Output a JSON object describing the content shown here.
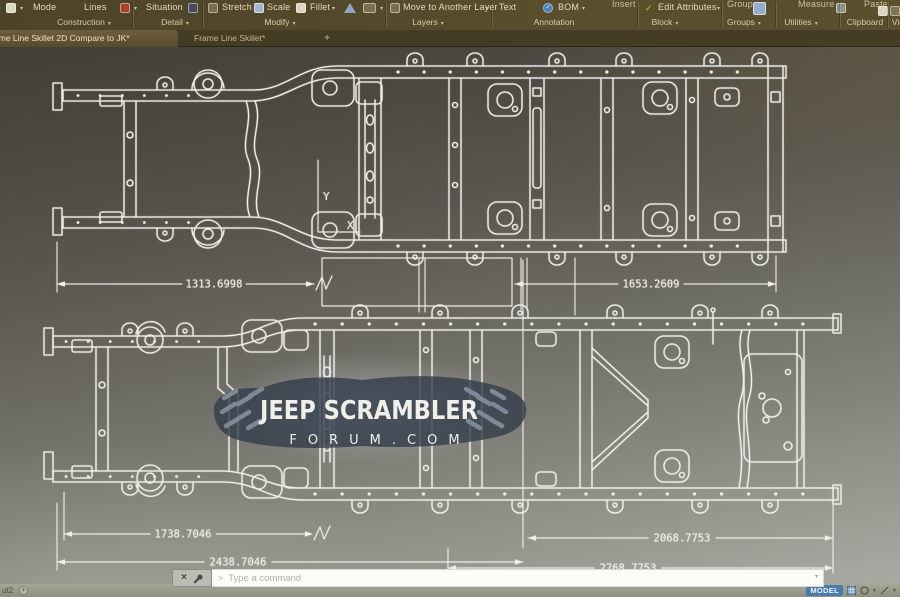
{
  "ribbon": {
    "tools": {
      "mode": "Mode",
      "lines": "Lines",
      "situation": "Situation",
      "stretch": "Stretch",
      "scale": "Scale",
      "fillet": "Fillet",
      "move_to_another_layer": "Move to Another Layer",
      "text": "Text",
      "bom": "BOM",
      "insert": "Insert",
      "edit_attributes": "Edit Attributes",
      "group": "Group",
      "measure": "Measure",
      "paste": "Paste"
    },
    "panels": {
      "construction": "Construction",
      "detail": "Detail",
      "modify": "Modify",
      "layers": "Layers",
      "annotation": "Annotation",
      "block": "Block",
      "groups": "Groups",
      "utilities": "Utilities",
      "clipboard": "Clipboard",
      "view": "View"
    },
    "dropdown_glyph": "▾"
  },
  "tabs": {
    "active": "Frame Line Skillet 2D Compare to JK*",
    "inactive": "Frame Line Skillet*",
    "new_tab": "+"
  },
  "drawing": {
    "dimensions": {
      "upper_left": "1313.6998",
      "upper_right": "1653.2609",
      "lower_inner_left": "1738.7046",
      "lower_inner_right": "2068.7753",
      "lower_outer_left": "2438.7046",
      "lower_outer_right": "2768.7753"
    },
    "ucs": {
      "x": "X",
      "y": "Y"
    },
    "watermark": {
      "title": "JEEP SCRAMBLER",
      "subtitle": "FORUM.COM"
    }
  },
  "command_line": {
    "prompt_glyph": ">",
    "placeholder": "Type a command",
    "close_glyph": "×"
  },
  "status_bar": {
    "layout_tab": "ut2",
    "new_layout_glyph": "+",
    "model_label": "MODEL",
    "dropdown_glyph": "▾"
  },
  "colors": {
    "accent_blue": "#4a7aae",
    "line_white": "#efeee9",
    "ribbon_bg": "#544929"
  }
}
